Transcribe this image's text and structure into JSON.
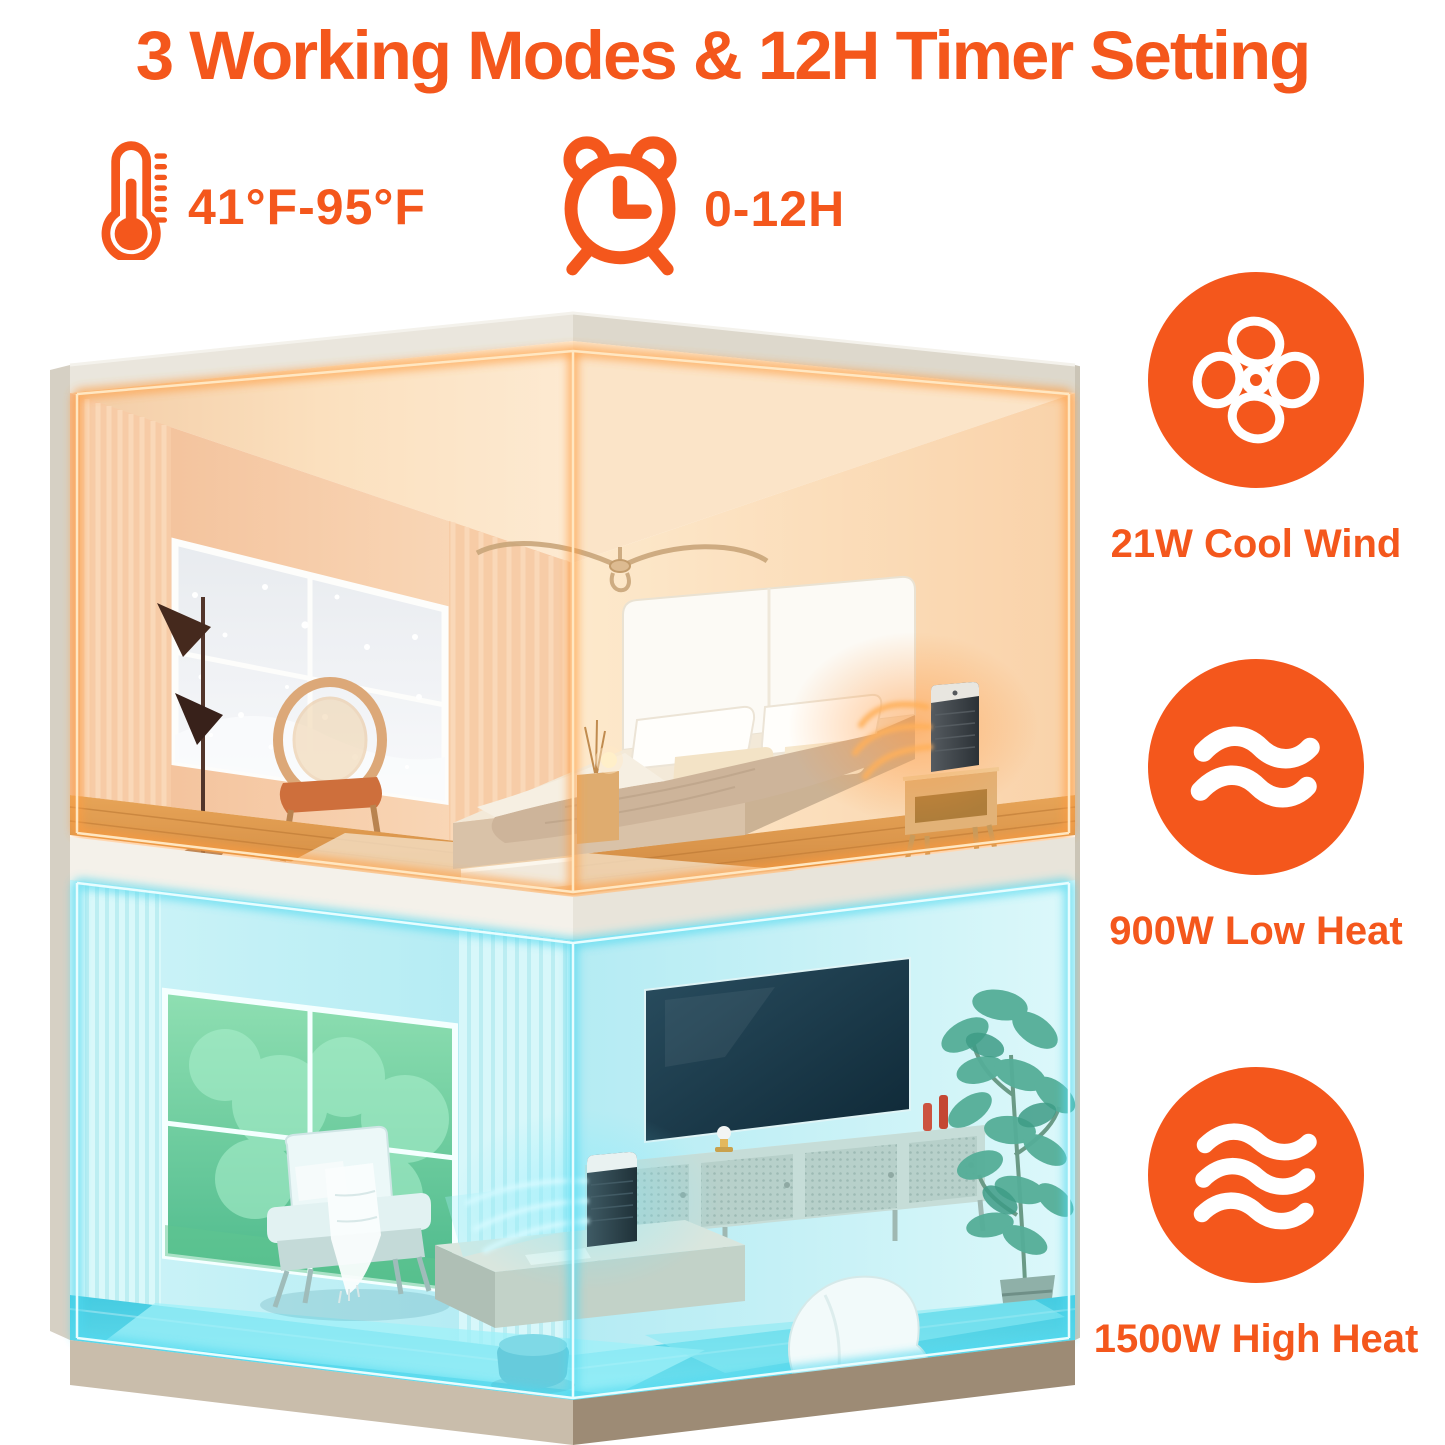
{
  "title": "3 Working Modes & 12H Timer Setting",
  "specs": {
    "temperature": {
      "icon": "thermometer-icon",
      "value": "41°F-95°F"
    },
    "timer": {
      "icon": "alarm-clock-icon",
      "value": "0-12H"
    }
  },
  "features": [
    {
      "icon": "fan-icon",
      "label": "21W Cool Wind"
    },
    {
      "icon": "heat-wave-2-icon",
      "label": "900W Low Heat"
    },
    {
      "icon": "heat-wave-3-icon",
      "label": "1500W High Heat"
    }
  ],
  "scene": {
    "top_room": "warm-bedroom-heating-glow",
    "bottom_room": "cool-living-room-fan-glow"
  },
  "colors": {
    "accent_orange": "#F4571C",
    "neon_orange": "#FFA04A",
    "neon_cyan": "#5FE0F5"
  }
}
